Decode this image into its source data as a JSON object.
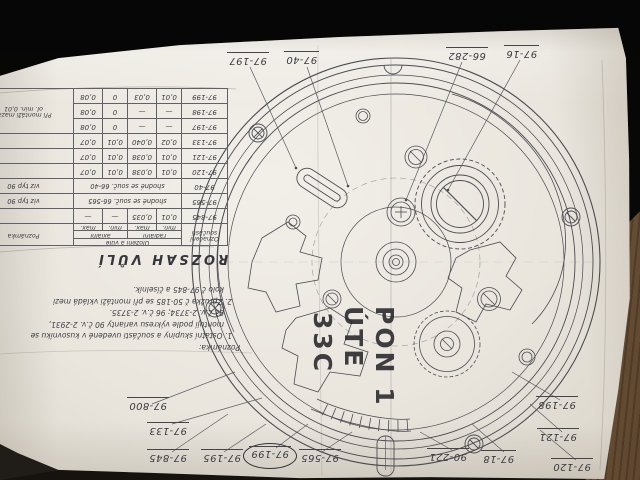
{
  "drawing": {
    "title": "ROZSAH VŮLÍ",
    "table": {
      "col_part_line1": "Označení",
      "col_part_line2": "součásti",
      "col_fit": "Uložení a vůle",
      "col_radial": "radiální",
      "col_axial": "axiální",
      "col_min": "min.",
      "col_max": "max.",
      "col_note": "Poznámka",
      "rows": [
        {
          "part": "97-845",
          "rmin": "0,01",
          "rmax": "0,035",
          "amin": "—",
          "amax": "—",
          "note": ""
        },
        {
          "part": "97-565",
          "span": "shodné se souč. 66-565",
          "note": "viz typ 90"
        },
        {
          "part": "97-40",
          "span": "shodné se souč. 66-40",
          "note": "viz typ 90"
        },
        {
          "part": "97-120",
          "rmin": "0,01",
          "rmax": "0,038",
          "amin": "0,01",
          "amax": "0,07",
          "note": ""
        },
        {
          "part": "97-121",
          "rmin": "0,01",
          "rmax": "0,038",
          "amin": "0,01",
          "amax": "0,07",
          "note": ""
        },
        {
          "part": "97-133",
          "rmin": "0,02",
          "rmax": "0,040",
          "amin": "0,01",
          "amax": "0,07",
          "note": ""
        },
        {
          "part": "97-197",
          "rmin": "—",
          "rmax": "—",
          "amin": "0",
          "amax": "0,08",
          "note_line1": "Při montáži mazat",
          "note_line2": "ol. min. 0,01"
        },
        {
          "part": "97-198",
          "rmin": "—",
          "rmax": "—",
          "amin": "0",
          "amax": "0,08"
        },
        {
          "part": "97-199",
          "rmin": "0,01",
          "rmax": "0,03",
          "amin": "0",
          "amax": "0,08"
        }
      ]
    },
    "notes": {
      "heading": "Poznámka:",
      "lines": [
        "1. Ostatní skupiny a součásti uvedené v kusovníku se",
        "montují podle výkresu varianty 90 č.v. 2-2931,",
        "91 č.v. 2-3734; 96 č.v. 2-3735.",
        "2. Zpružka č 50-185 se při montáži vkládá mezi",
        "kolo č 97-845 a číselník."
      ]
    },
    "callouts": [
      {
        "text": "97-197"
      },
      {
        "text": "97-40"
      },
      {
        "text": "66-282"
      },
      {
        "text": "97-16"
      },
      {
        "text": "97-800"
      },
      {
        "text": "97-133"
      },
      {
        "text": "97-845"
      },
      {
        "text": "97-195"
      },
      {
        "text": "97-199"
      },
      {
        "text": "97-565"
      },
      {
        "text": "90-221"
      },
      {
        "text": "97-18"
      },
      {
        "text": "97-120"
      },
      {
        "text": "97-121"
      },
      {
        "text": "97-198"
      }
    ],
    "handwriting": {
      "line1": "PON 1",
      "line2": "ÚTE",
      "line3": "33C"
    }
  }
}
